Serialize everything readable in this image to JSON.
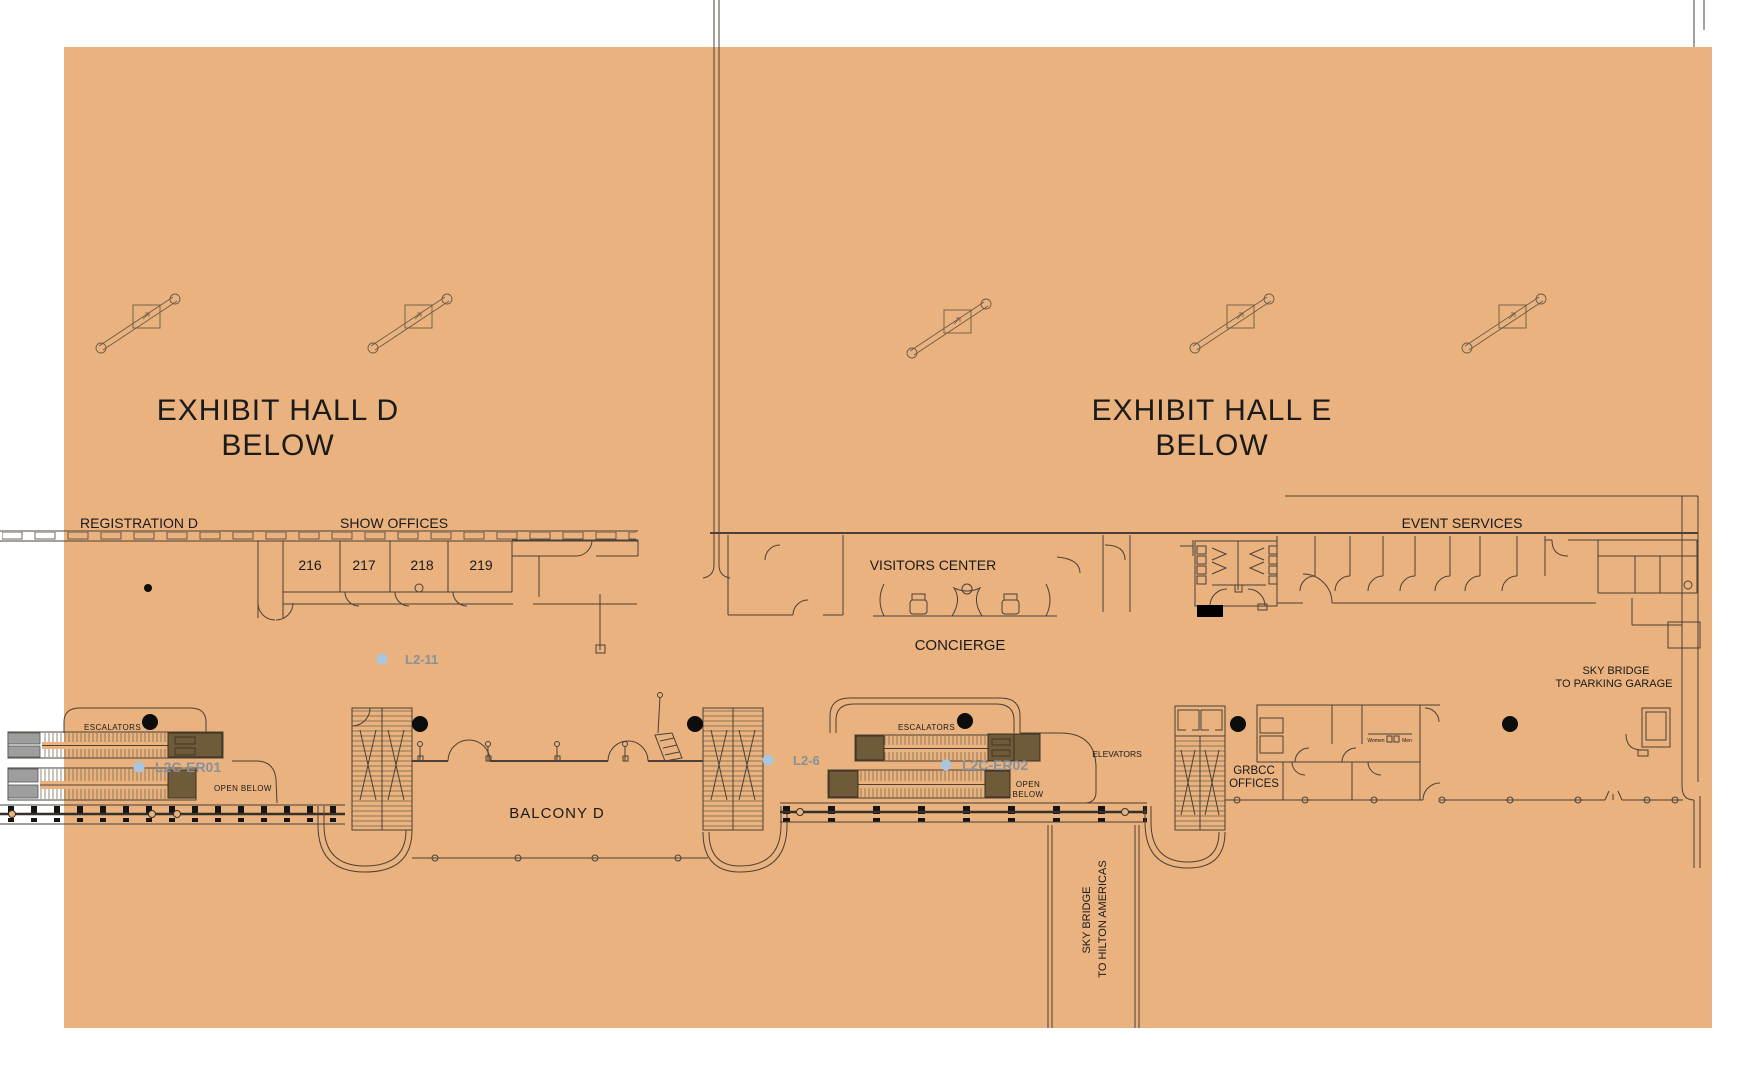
{
  "plan": {
    "halls": {
      "d_line1": "EXHIBIT HALL D",
      "d_line2": "BELOW",
      "e_line1": "EXHIBIT HALL E",
      "e_line2": "BELOW"
    },
    "areas": {
      "registration": "REGISTRATION D",
      "show_offices": "SHOW OFFICES",
      "event_services": "EVENT SERVICES",
      "visitors_center": "VISITORS CENTER",
      "concierge": "CONCIERGE",
      "balcony": "BALCONY D",
      "escalators": "ESCALATORS",
      "open_below": "OPEN BELOW",
      "open_below2_line1": "OPEN",
      "open_below2_line2": "BELOW",
      "elevators": "ELEVATORS",
      "grbcc_line1": "GRBCC",
      "grbcc_line2": "OFFICES",
      "women": "Women",
      "men": "Men"
    },
    "rooms": [
      "216",
      "217",
      "218",
      "219"
    ],
    "sky_bridges": {
      "parking_line1": "SKY BRIDGE",
      "parking_line2": "TO PARKING GARAGE",
      "hilton_line1": "SKY BRIDGE",
      "hilton_line2": "TO HILTON AMERICAS"
    },
    "devices": [
      {
        "id": "L2-11"
      },
      {
        "id": "L2C-ER01"
      },
      {
        "id": "L2-6"
      },
      {
        "id": "L2C-ER02"
      }
    ],
    "colors": {
      "background": "#e9b27e",
      "wall": "#4a4038",
      "label": "#1a1a1a",
      "device_text": "#87919b",
      "device_dot": "#a9c6de",
      "escalator_cap": "#6f5a39",
      "escalator_cap_gray": "#9e9e9e",
      "location_dot": "#0d0d0d"
    }
  }
}
